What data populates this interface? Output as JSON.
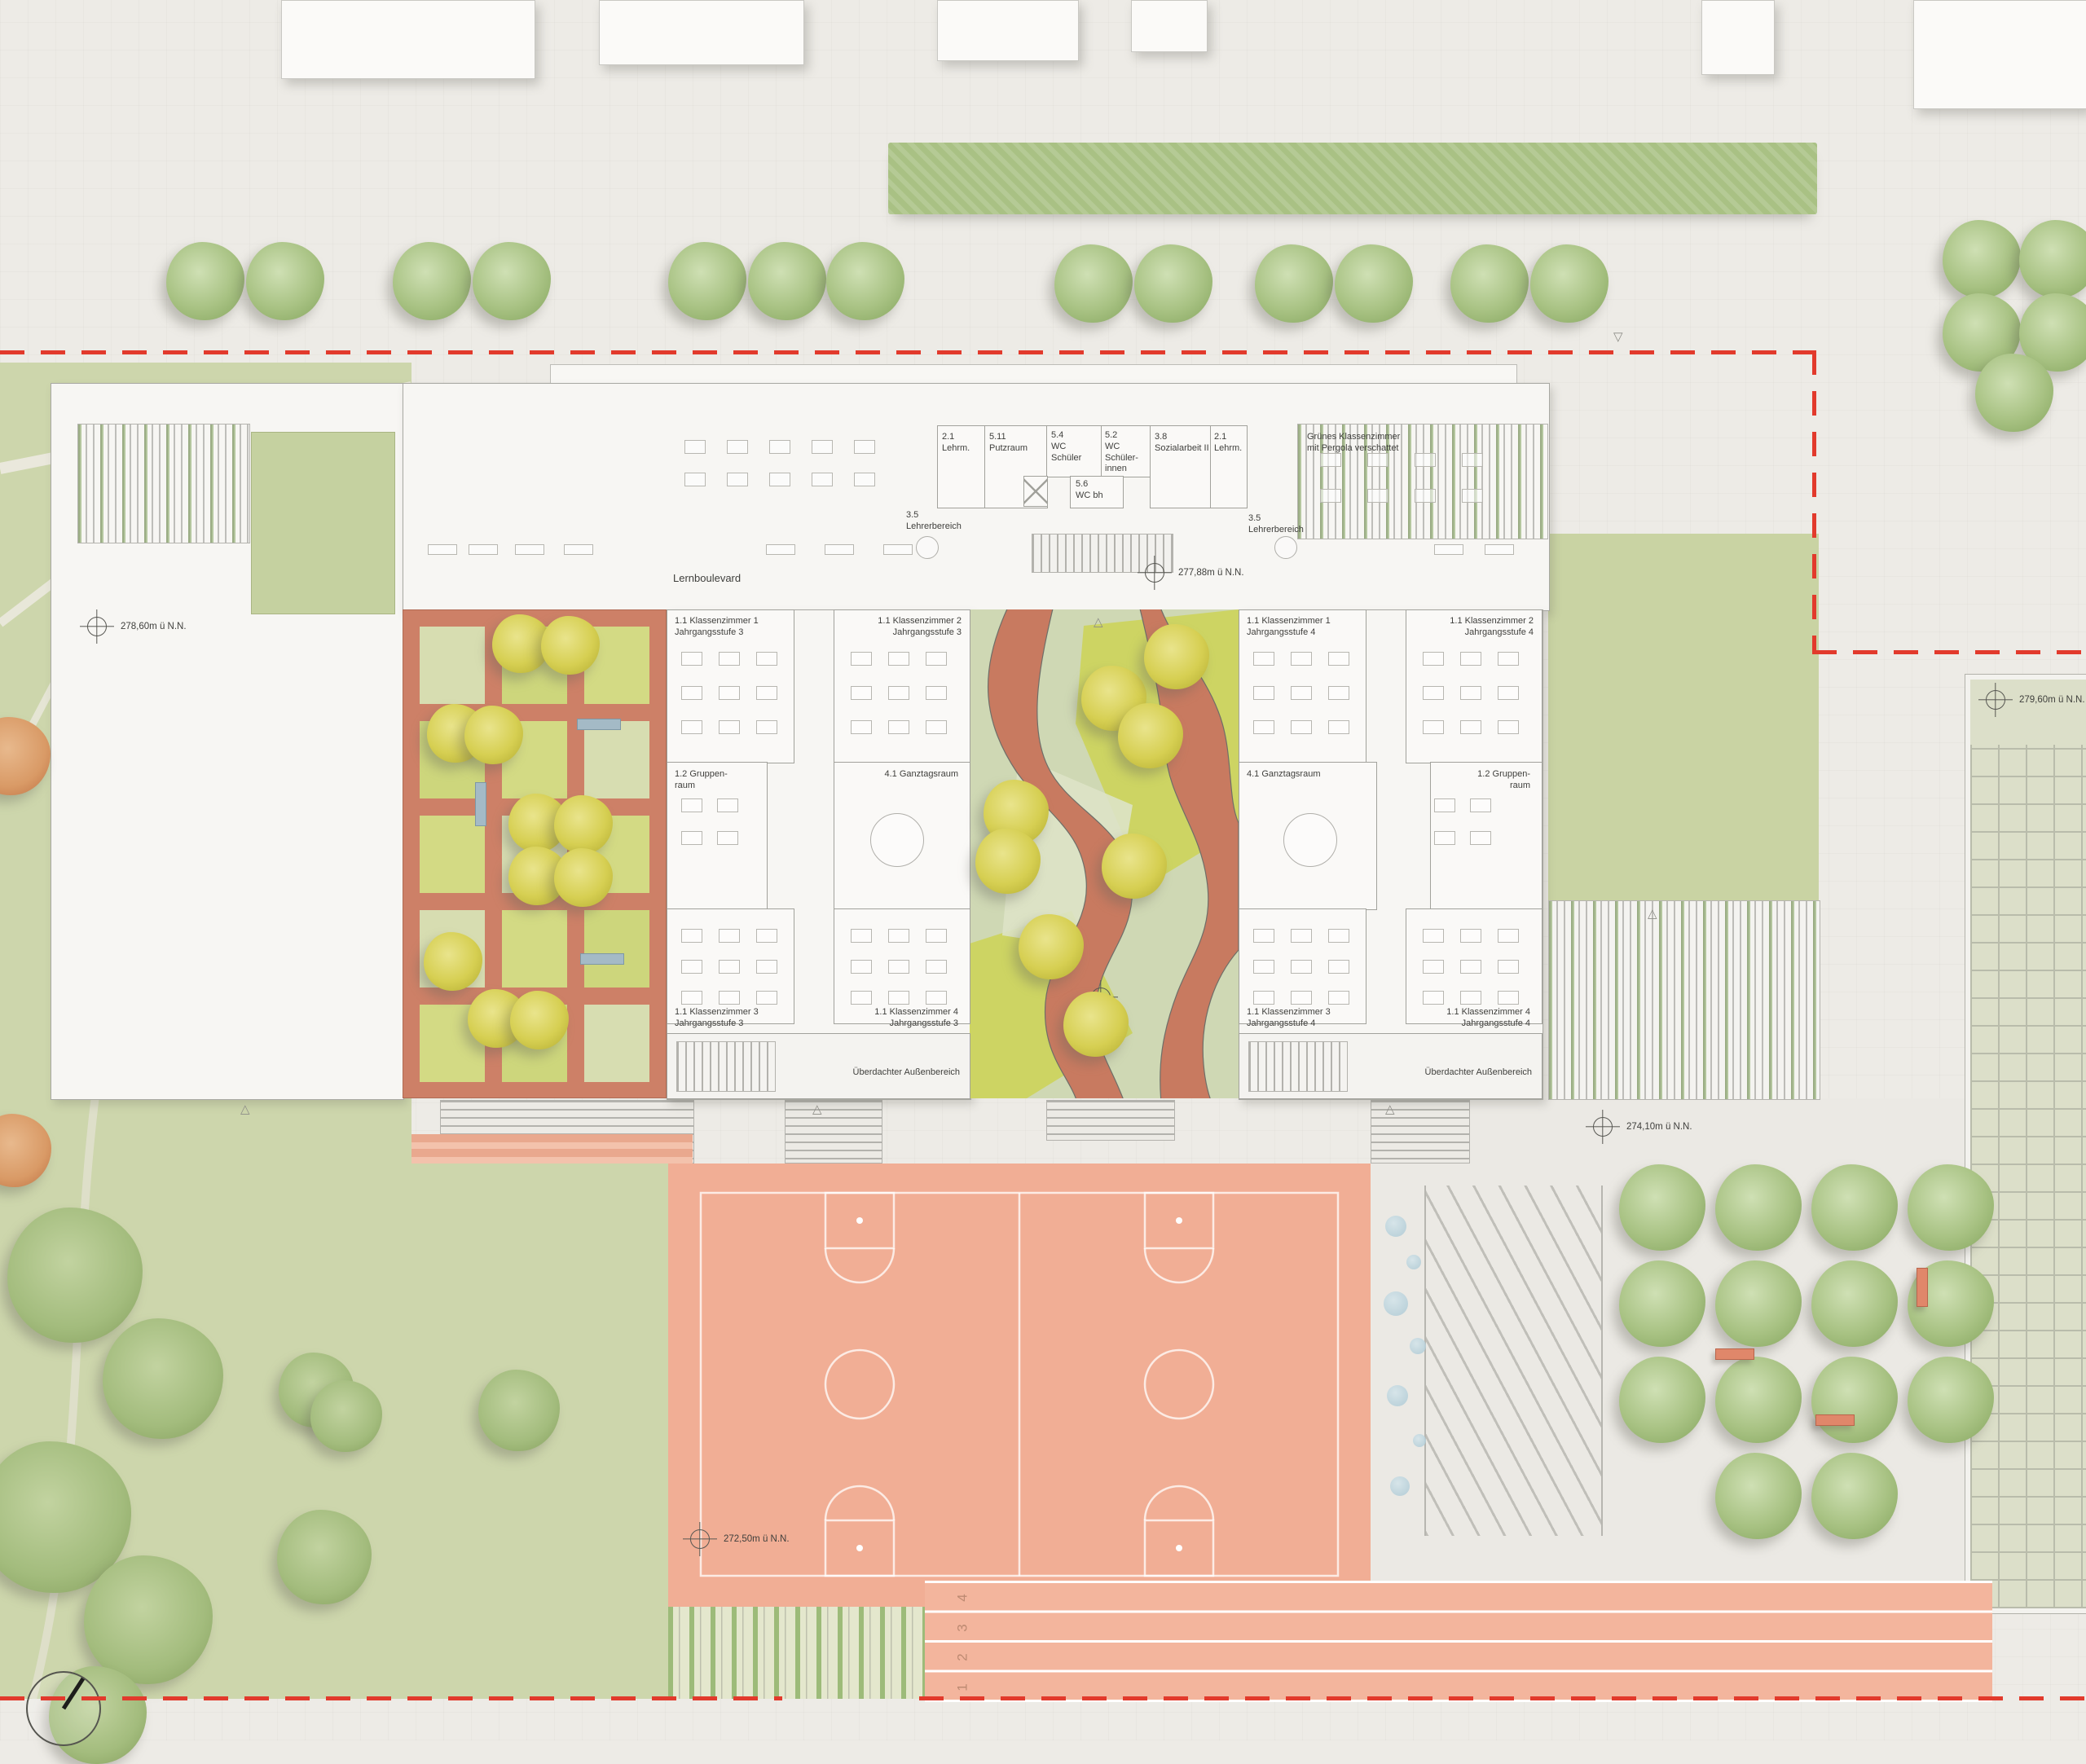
{
  "plan": {
    "corridor_label": "Lernboulevard",
    "levels": {
      "park": "278,60m ü N.N.",
      "boulevard": "277,88m ü N.N.",
      "east_court": "279,60m ü N.N.",
      "plaza": "274,10m ü N.N.",
      "sports_field": "272,50m ü N.N."
    },
    "north_rooms": [
      "2.1\nLehrm.",
      "5.11\nPutzraum",
      "5.4\nWC\nSchüler",
      "5.2\nWC\nSchüler-\ninnen",
      "3.8\nSozialarbeit II",
      "2.1\nLehrm.",
      "5.6\nWC bh"
    ],
    "teacher_areas": [
      "3.5\nLehrerbereich",
      "3.5\nLehrerbereich"
    ],
    "green_classroom": "Grünes Klassenzimmer\nmit Pergola verschattet",
    "wings": [
      {
        "rooms": [
          "1.1 Klassenzimmer 1\nJahrgangsstufe 3",
          "1.1 Klassenzimmer 2\nJahrgangsstufe 3",
          "1.2 Gruppen-\nraum",
          "4.1 Ganztagsraum",
          "1.1 Klassenzimmer 3\nJahrgangsstufe 3",
          "1.1 Klassenzimmer 4\nJahrgangsstufe 3"
        ],
        "covered": "Überdachter Außenbereich"
      },
      {
        "rooms": [
          "1.1 Klassenzimmer 1\nJahrgangsstufe 4",
          "1.1 Klassenzimmer 2\nJahrgangsstufe 4",
          "4.1 Ganztagsraum",
          "1.2 Gruppen-\nraum",
          "1.1 Klassenzimmer 3\nJahrgangsstufe 4",
          "1.1 Klassenzimmer 4\nJahrgangsstufe 4"
        ],
        "covered": "Überdachter Außenbereich"
      }
    ],
    "track_lanes": [
      "1",
      "2",
      "3",
      "4"
    ],
    "colors": {
      "paving": "#edebe6",
      "park_green": "#cdd6ac",
      "lawn_green": "#c3ce9f",
      "courtyard_green": "#ccd45f",
      "path_salmon": "#c87a60",
      "sports_field": "#f1ae95",
      "track": "#f3b59d",
      "hedge": "#a9c184",
      "tree_green": "#a8c283",
      "tree_yellow": "#d6cf52",
      "building_white": "#f8f7f4",
      "boundary_red": "#e23a2c"
    }
  }
}
